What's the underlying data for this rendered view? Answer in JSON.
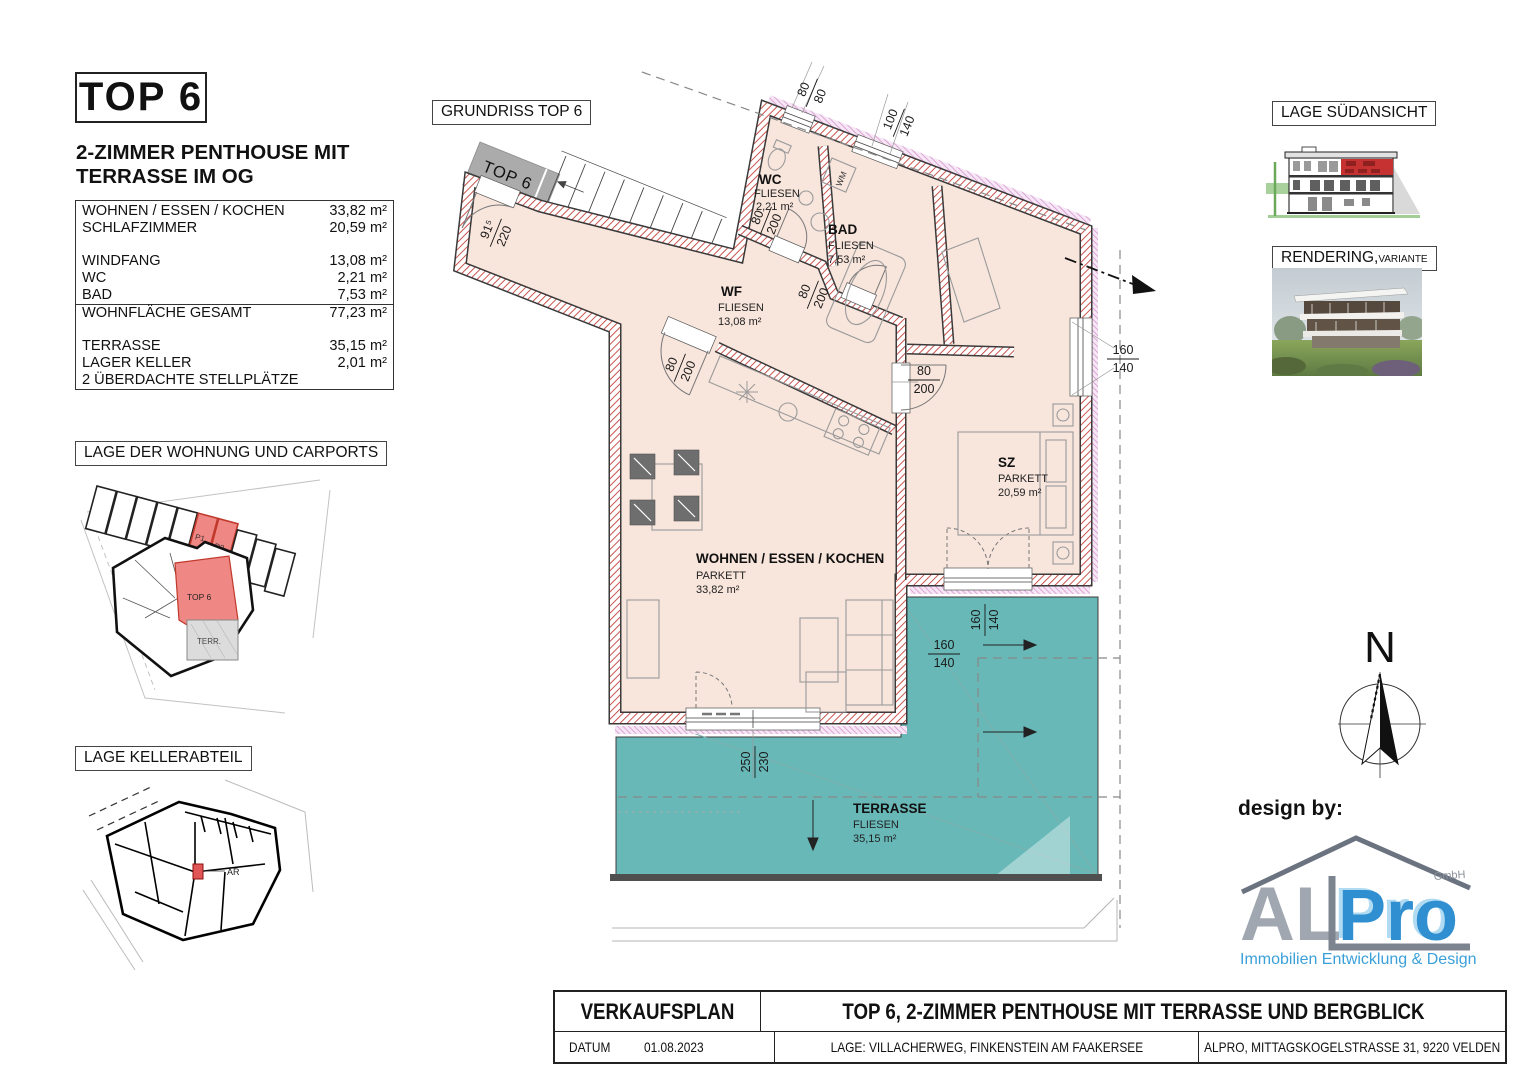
{
  "header": {
    "top_label": "TOP 6",
    "subtitle_line1": "2-ZIMMER PENTHOUSE MIT",
    "subtitle_line2": "TERRASSE IM OG"
  },
  "area_table": {
    "rows": [
      {
        "label": "WOHNEN / ESSEN / KOCHEN",
        "value": "33,82 m²"
      },
      {
        "label": "SCHLAFZIMMER",
        "value": "20,59 m²"
      },
      {
        "label": "",
        "value": ""
      },
      {
        "label": "WINDFANG",
        "value": "13,08 m²"
      },
      {
        "label": "WC",
        "value": "2,21 m²"
      },
      {
        "label": "BAD",
        "value": "7,53 m²"
      },
      {
        "label": "WOHNFLÄCHE GESAMT",
        "value": "77,23 m²"
      },
      {
        "label": "",
        "value": ""
      },
      {
        "label": "TERRASSE",
        "value": "35,15 m²"
      },
      {
        "label": "LAGER KELLER",
        "value": "2,01 m²"
      },
      {
        "label": "2 ÜBERDACHTE STELLPLÄTZE",
        "value": ""
      }
    ]
  },
  "section_labels": {
    "site": "LAGE DER WOHNUNG UND CARPORTS",
    "keller": "LAGE KELLERABTEIL",
    "grundriss": "GRUNDRISS TOP 6",
    "suedansicht": "LAGE SÜDANSICHT",
    "rendering_main": "RENDERING,",
    "rendering_small": "VARIANTE"
  },
  "plan": {
    "entry_label": "TOP 6",
    "wm_label": "WM",
    "rooms": {
      "wc": {
        "name": "WC",
        "floor": "FLIESEN",
        "area": "2,21 m²"
      },
      "bad": {
        "name": "BAD",
        "floor": "FLIESEN",
        "area": "7,53 m²"
      },
      "wf": {
        "name": "WF",
        "floor": "FLIESEN",
        "area": "13,08 m²"
      },
      "wohnen": {
        "name": "WOHNEN / ESSEN / KOCHEN",
        "floor": "PARKETT",
        "area": "33,82 m²"
      },
      "sz": {
        "name": "SZ",
        "floor": "PARKETT",
        "area": "20,59 m²"
      },
      "terrasse": {
        "name": "TERRASSE",
        "floor": "FLIESEN",
        "area": "35,15 m²"
      }
    },
    "dims": {
      "d1": {
        "a": "80",
        "b": "80"
      },
      "d2": {
        "a": "100",
        "b": "140"
      },
      "d3": {
        "a": "80",
        "b": "200"
      },
      "d4": {
        "a": "80",
        "b": "200"
      },
      "d5": {
        "a": "80",
        "b": "200"
      },
      "d6": {
        "a": "91⁵",
        "b": "220"
      },
      "d7": {
        "a": "80",
        "b": "200"
      },
      "d8": {
        "a": "160",
        "b": "140"
      },
      "d9": {
        "a": "160",
        "b": "140"
      },
      "d10": {
        "a": "160",
        "b": "140"
      },
      "d11": {
        "a": "250",
        "b": "230"
      }
    }
  },
  "site_plan": {
    "p1": "P1",
    "p2": "P2",
    "top6": "TOP 6",
    "terr": "TERR."
  },
  "keller_plan": {
    "ar_label": "AR"
  },
  "compass": {
    "n": "N"
  },
  "footer": {
    "design_by": "design by:"
  },
  "logo": {
    "al": "AL",
    "pro": "Pro",
    "gmbh": "GmbH",
    "tagline": "Immobilien Entwicklung & Design"
  },
  "title_block": {
    "doc_type": "VERKAUFSPLAN",
    "title": "TOP 6, 2-ZIMMER PENTHOUSE MIT TERRASSE UND BERGBLICK",
    "date_label": "DATUM",
    "date": "01.08.2023",
    "location": "LAGE: VILLACHERWEG, FINKENSTEIN AM FAAKERSEE",
    "company": "ALPRO, MITTAGSKOGELSTRASSE 31, 9220 VELDEN"
  },
  "colors": {
    "wall_hatch": "#c4403a",
    "insulation": "#d193cc",
    "floor": "#f8e5dc",
    "terrace": "#68b8b8",
    "highlight_red": "#ef8784",
    "elevation_red": "#c63232",
    "logo_blue": "#2f8fd0",
    "logo_gray": "#98a0aa",
    "tagline_blue": "#3ba0da"
  }
}
